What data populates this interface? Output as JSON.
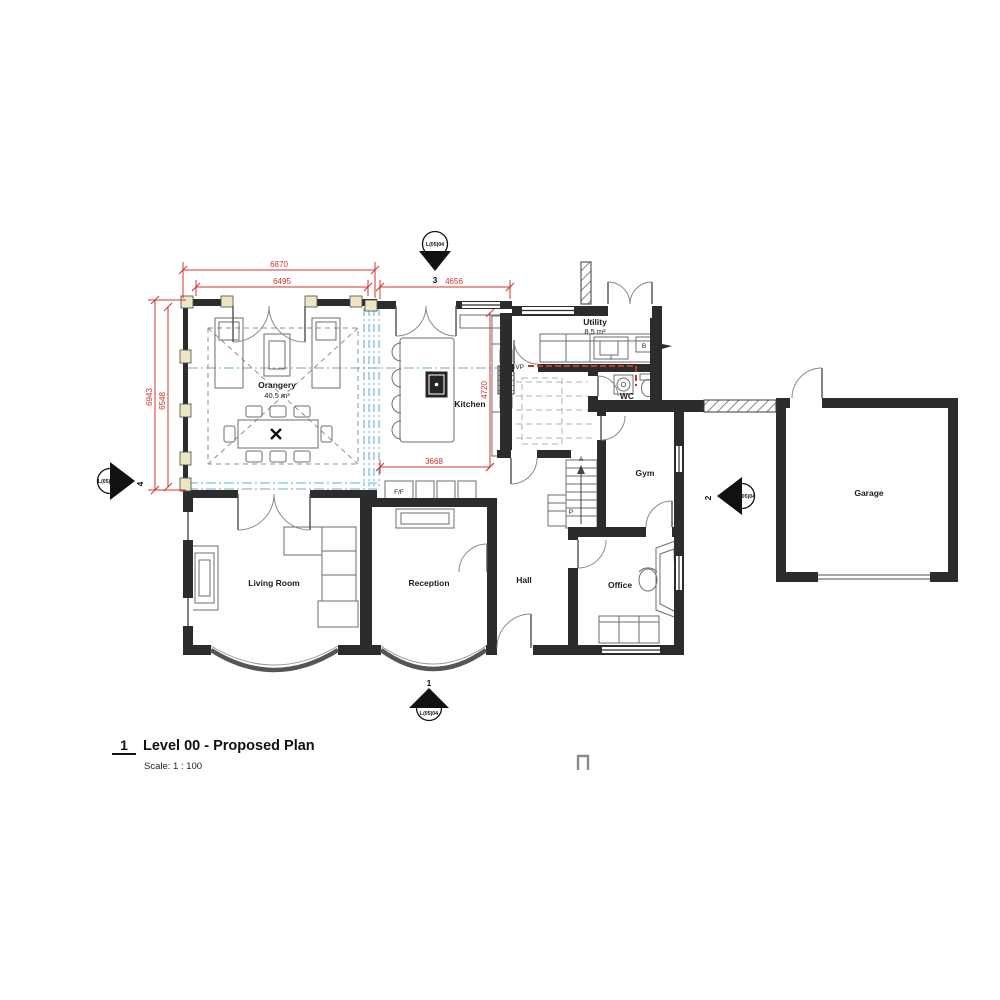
{
  "colors": {
    "wall": "#2c2c2c",
    "dimension_red": "#d0342c",
    "glazing_blue": "#6aaed6",
    "pier_cream": "#ede6c4",
    "furniture_grey": "#6e6e6e"
  },
  "title_block": {
    "drawing_number": "1",
    "title": "Level 00 - Proposed Plan",
    "scale": "Scale:  1 : 100"
  },
  "rooms": {
    "orangery": {
      "name": "Orangery",
      "area": "40.5 m²"
    },
    "kitchen": {
      "name": "Kitchen"
    },
    "utility": {
      "name": "Utility",
      "area": "8.5 m²"
    },
    "wc": {
      "name": "WC"
    },
    "gym": {
      "name": "Gym"
    },
    "hall": {
      "name": "Hall"
    },
    "living_room": {
      "name": "Living Room"
    },
    "reception": {
      "name": "Reception"
    },
    "office": {
      "name": "Office"
    },
    "garage": {
      "name": "Garage"
    }
  },
  "dimensions_mm": {
    "orangery_width_overall": "6870",
    "orangery_width_internal": "6495",
    "kitchen_width": "4656",
    "orangery_depth_overall": "6943",
    "orangery_depth_internal": "6548",
    "kitchen_depth": "4720",
    "kitchen_clear_width": "3668"
  },
  "annotations": {
    "svp": "SVP",
    "fridge_freezer": "F/F",
    "boiler": "B",
    "pantry": "P",
    "stair_arrow": "A"
  },
  "section_markers": {
    "sheet_ref": "L(05)04",
    "top": {
      "number": "3"
    },
    "bottom": {
      "number": "1"
    },
    "left": {
      "number": "4"
    },
    "right": {
      "number": "2"
    }
  }
}
